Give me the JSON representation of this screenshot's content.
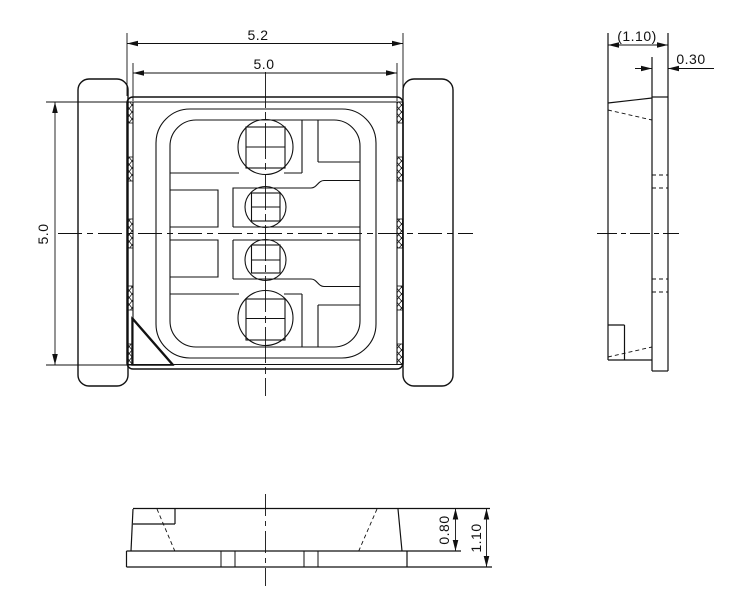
{
  "drawing": {
    "views": {
      "top": {
        "dims": {
          "outer_width": "5.2",
          "body_width": "5.0",
          "body_height": "5.0"
        }
      },
      "side": {
        "dims": {
          "overall_width": "(1.10)",
          "lead_width": "0.30"
        }
      },
      "front": {
        "dims": {
          "body_height": "0.80",
          "overall_height": "1.10"
        }
      }
    },
    "colors": {
      "line": "#111111",
      "background": "#ffffff"
    }
  }
}
